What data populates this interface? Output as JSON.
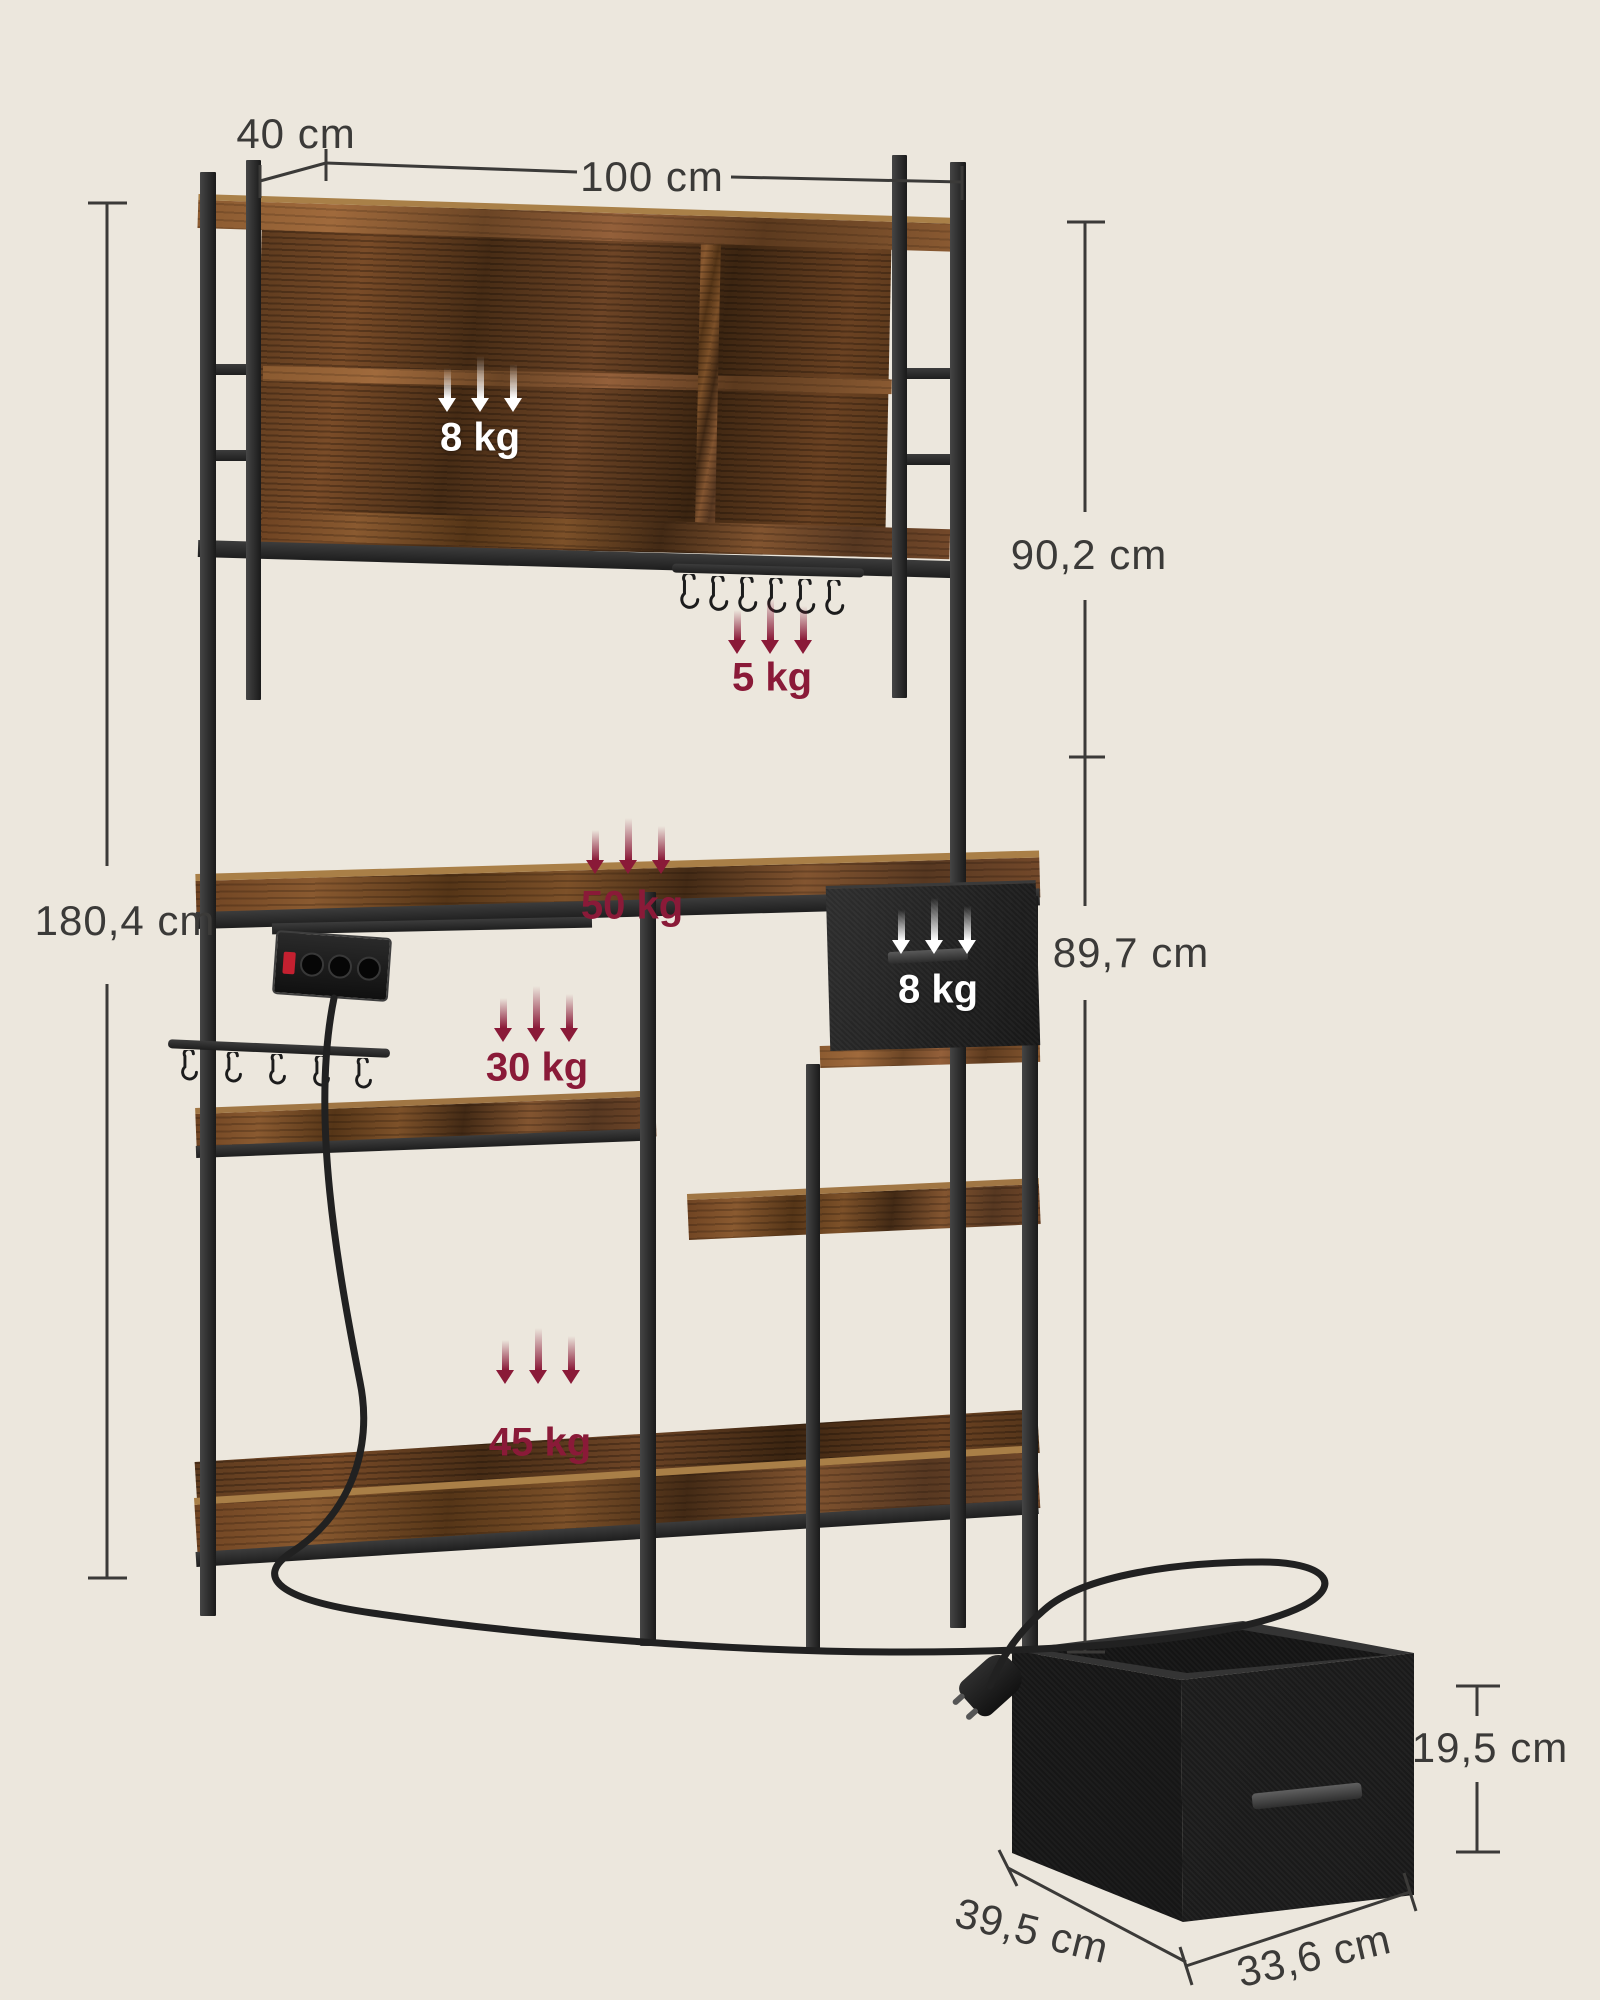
{
  "dims": {
    "top_depth": "40 cm",
    "top_width": "100 cm",
    "total_height": "180,4 cm",
    "hutch_height": "90,2 cm",
    "base_height": "89,7 cm",
    "box_height": "19,5 cm",
    "box_depth": "39,5 cm",
    "box_width": "33,6 cm"
  },
  "loads": {
    "hutch_shelf": "8 kg",
    "hooks": "5 kg",
    "countertop": "50 kg",
    "middle_shelf": "30 kg",
    "drawer": "8 kg",
    "bottom_shelf": "45 kg"
  },
  "colors": {
    "background": "#ece7dd",
    "dimension_text": "#3b3a38",
    "load_red": "#8a1a38",
    "load_white": "#ffffff",
    "wood": "#7a4c28",
    "metal": "#262626"
  }
}
